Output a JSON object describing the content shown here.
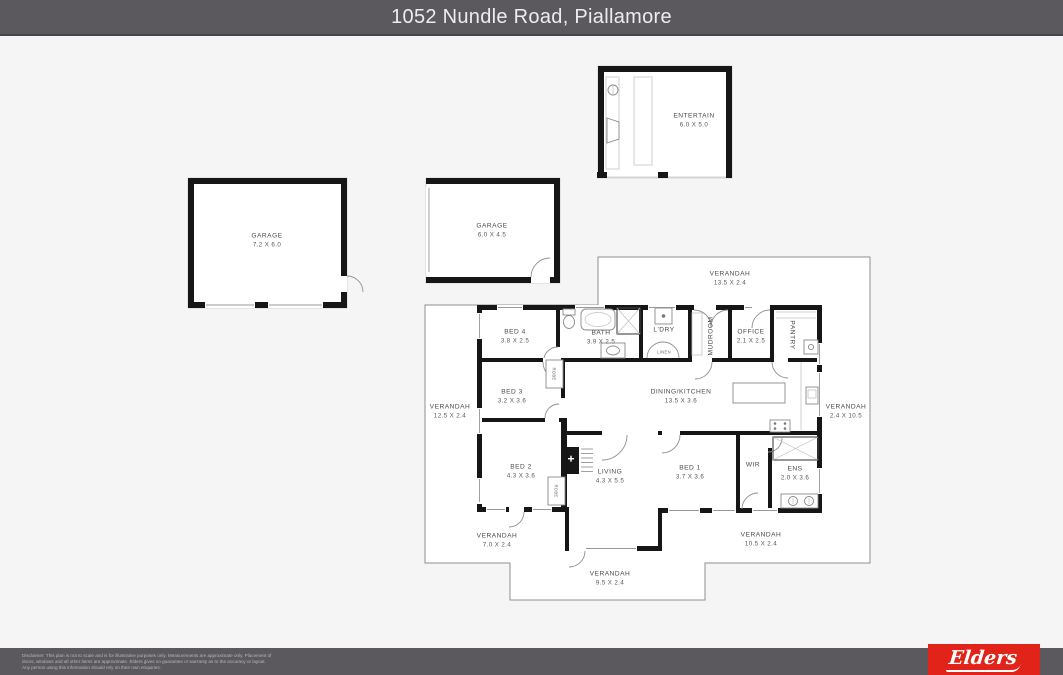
{
  "header": {
    "title": "1052 Nundle Road, Piallamore"
  },
  "plan": {
    "outbuildings": {
      "entertain": {
        "name": "ENTERTAIN",
        "dims": "6.0 X 5.0"
      },
      "garage_large": {
        "name": "GARAGE",
        "dims": "7.2 X 6.0"
      },
      "garage_small": {
        "name": "GARAGE",
        "dims": "6.0 X 4.5"
      }
    },
    "rooms": {
      "bed4": {
        "name": "BED 4",
        "dims": "3.8 X 2.5"
      },
      "bath": {
        "name": "BATH",
        "dims": "3.9 X 2.5"
      },
      "ldry": {
        "name": "L'DRY"
      },
      "linen": {
        "name": "LINEN"
      },
      "mudroom": {
        "name": "MUDROOM"
      },
      "office": {
        "name": "OFFICE",
        "dims": "2.1 X 2.5"
      },
      "pantry": {
        "name": "PANTRY"
      },
      "dining_kitchen": {
        "name": "DINING/KITCHEN",
        "dims": "13.5 X 3.6"
      },
      "bed3": {
        "name": "BED 3",
        "dims": "3.2 X 3.6"
      },
      "robe_bed3": {
        "name": "ROBE"
      },
      "bed2": {
        "name": "BED 2",
        "dims": "4.3 X 3.6"
      },
      "robe_bed2": {
        "name": "ROBE"
      },
      "living": {
        "name": "LIVING",
        "dims": "4.3 X 5.5"
      },
      "bed1": {
        "name": "BED 1",
        "dims": "3.7 X 3.6"
      },
      "wir": {
        "name": "WIR"
      },
      "ens": {
        "name": "ENS",
        "dims": "2.0 X 3.6"
      }
    },
    "verandahs": {
      "top": {
        "name": "VERANDAH",
        "dims": "13.5 X 2.4"
      },
      "left": {
        "name": "VERANDAH",
        "dims": "12.5 X 2.4"
      },
      "right": {
        "name": "VERANDAH",
        "dims": "2.4 X 10.5"
      },
      "bottom_left": {
        "name": "VERANDAH",
        "dims": "7.0 X 2.4"
      },
      "bottom_right": {
        "name": "VERANDAH",
        "dims": "10.5 X 2.4"
      },
      "bottom_center": {
        "name": "VERANDAH",
        "dims": "9.5 X 2.4"
      }
    }
  },
  "footer": {
    "disclaimer_line1": "Disclaimer: This plan is not to scale and is for illustrative purposes only. Measurements are approximate only. Placement of",
    "disclaimer_line2": "doors, windows and all other items are approximate. Elders gives no guarantee or warranty as to the accuracy or layout.",
    "disclaimer_line3": "Any person using this information should rely on their own enquiries.",
    "logo_text": "Elders"
  },
  "colors": {
    "header_bg": "#5b595d",
    "wall": "#161616",
    "plan_fill": "#ffffff",
    "background": "#f5f5f5",
    "logo_red": "#e2231a"
  }
}
